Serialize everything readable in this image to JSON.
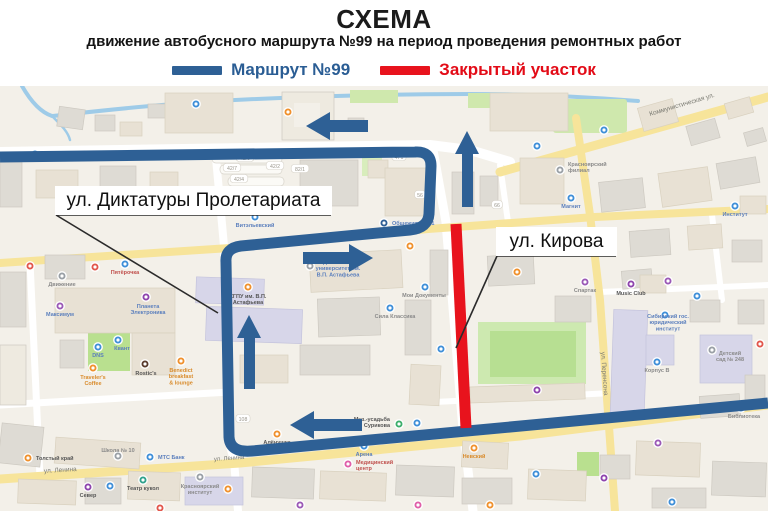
{
  "header": {
    "title": "СХЕМА",
    "subtitle": "движение автобусного маршрута №99 на период проведения ремонтных работ"
  },
  "legend": {
    "route": {
      "label": "Маршрут №99",
      "color": "#2e6095"
    },
    "closed": {
      "label": "Закрытый участок",
      "color": "#e8131d"
    }
  },
  "map": {
    "route": {
      "name": "Маршрут №99",
      "color": "#2e6095",
      "width": 11,
      "svg_path": "M 768,403 L 252,451 Q 230,453 229,437 L 226,262 Q 225,248 241,246 L 410,230 Q 428,228 429,214 L 431,166 Q 431,151 415,152 L 0,157",
      "arrows": [
        {
          "dir": "left",
          "points": "306,126 330,112 330,120 368,120 368,132 330,132 330,140"
        },
        {
          "dir": "up",
          "points": "467,131 455,154 462,154 462,207 473,207 473,154 479,154"
        },
        {
          "dir": "right",
          "points": "373,258 349,244 349,252 303,252 303,264 349,264 349,272"
        },
        {
          "dir": "up",
          "points": "249,315 237,338 244,338 244,389 255,389 255,338 261,338"
        },
        {
          "dir": "left",
          "points": "290,425 314,411 314,419 362,419 362,431 314,431 314,439"
        }
      ]
    },
    "closed_section": {
      "name": "Закрытый участок",
      "color": "#e8131d",
      "width": 11,
      "x1": 456,
      "y1": 224,
      "x2": 466,
      "y2": 428
    },
    "callouts": [
      {
        "label": "ул. Диктатуры Пролетариата",
        "box": {
          "x": 55,
          "y": 186,
          "w": 277,
          "h": 29
        },
        "underline": {
          "x1": 56,
          "y1": 215,
          "x2": 331,
          "y2": 215
        },
        "leader": {
          "x1": 56,
          "y1": 215,
          "x2": 218,
          "y2": 313
        }
      },
      {
        "label": "ул. Кирова",
        "box": {
          "x": 496,
          "y": 227,
          "w": 121,
          "h": 29
        },
        "underline": {
          "x1": 497,
          "y1": 256,
          "x2": 616,
          "y2": 256
        },
        "leader": {
          "x1": 497,
          "y1": 256,
          "x2": 456,
          "y2": 348
        }
      }
    ],
    "street_names": [
      {
        "text": "Коммунистическая ул.",
        "x": 650,
        "y": 116,
        "rotate": -16.5,
        "size": 6.5
      },
      {
        "text": "ул. Перенсона",
        "x": 601,
        "y": 352,
        "rotate": 86,
        "size": 6.5
      },
      {
        "text": "ул. Ленина",
        "x": 44,
        "y": 473,
        "rotate": -3.5,
        "size": 6.5
      },
      {
        "text": "ул. Ленина",
        "x": 214,
        "y": 461,
        "rotate": -4,
        "size": 6
      }
    ],
    "pois": [
      {
        "x": 288,
        "y": 112,
        "c": "#f0912d"
      },
      {
        "x": 35,
        "y": 154,
        "c": "#3f8fd8"
      },
      {
        "x": 196,
        "y": 104,
        "c": "#3f8fd8"
      },
      {
        "x": 537,
        "y": 146,
        "c": "#3f8fd8"
      },
      {
        "x": 604,
        "y": 130,
        "c": "#3f8fd8"
      },
      {
        "x": 560,
        "y": 170,
        "c": "#9aa0a6",
        "lines": [
          "Красноярский",
          "филиал"
        ],
        "lx": 568,
        "ly": 166,
        "lc": "#8a8a8a",
        "anchor": "start"
      },
      {
        "x": 571,
        "y": 198,
        "c": "#3f8fd8",
        "lines": [
          "Магнит"
        ],
        "lx": 571,
        "ly": 208,
        "lc": "#5b7fbd"
      },
      {
        "x": 255,
        "y": 217,
        "c": "#3f8fd8",
        "lines": [
          "Витэльевский"
        ],
        "lx": 255,
        "ly": 227,
        "lc": "#5b7fbd"
      },
      {
        "x": 384,
        "y": 223,
        "c": "#2f5f96",
        "lines": [
          "Общежитие №1"
        ],
        "lx": 392,
        "ly": 225,
        "lc": "#5b7fbd",
        "anchor": "start"
      },
      {
        "x": 410,
        "y": 246,
        "c": "#f0912d"
      },
      {
        "x": 517,
        "y": 272,
        "c": "#f0912d"
      },
      {
        "x": 585,
        "y": 282,
        "c": "#9b59b6",
        "lines": [
          "Спартак"
        ],
        "lx": 585,
        "ly": 292,
        "lc": "#8a8a8a"
      },
      {
        "x": 631,
        "y": 284,
        "c": "#8e44ad",
        "lines": [
          "Music Club"
        ],
        "lx": 631,
        "ly": 295,
        "lc": "#555555"
      },
      {
        "x": 668,
        "y": 281,
        "c": "#9b59b6"
      },
      {
        "x": 697,
        "y": 296,
        "c": "#3f8fd8"
      },
      {
        "x": 735,
        "y": 206,
        "c": "#3f8fd8",
        "lines": [
          "Институт"
        ],
        "lx": 735,
        "ly": 216,
        "lc": "#5b7fbd"
      },
      {
        "x": 244,
        "y": 199,
        "c": "#3f8fd8"
      },
      {
        "x": 95,
        "y": 267,
        "c": "#e2574c"
      },
      {
        "x": 30,
        "y": 266,
        "c": "#e2574c"
      },
      {
        "x": 62,
        "y": 276,
        "c": "#9aa0a6",
        "lines": [
          "Движение"
        ],
        "lx": 62,
        "ly": 286,
        "lc": "#8a8a8a"
      },
      {
        "x": 125,
        "y": 264,
        "c": "#3f8fd8",
        "lines": [
          "Пятёрочка"
        ],
        "lx": 125,
        "ly": 274,
        "lc": "#c0504d"
      },
      {
        "x": 60,
        "y": 306,
        "c": "#9b59b6",
        "lines": [
          "Максимум"
        ],
        "lx": 60,
        "ly": 316,
        "lc": "#5b7fbd"
      },
      {
        "x": 146,
        "y": 297,
        "c": "#8e44ad",
        "lines": [
          "Планета",
          "Электроника"
        ],
        "lx": 148,
        "ly": 308,
        "lc": "#5b7fbd"
      },
      {
        "x": 98,
        "y": 347,
        "c": "#3f8fd8",
        "lines": [
          "DNS"
        ],
        "lx": 98,
        "ly": 357,
        "lc": "#5b7fbd"
      },
      {
        "x": 118,
        "y": 340,
        "c": "#3f8fd8",
        "lines": [
          "Квант"
        ],
        "lx": 122,
        "ly": 350,
        "lc": "#5b7fbd"
      },
      {
        "x": 145,
        "y": 364,
        "c": "#5a3c2e",
        "lines": [
          "Rostic's"
        ],
        "lx": 146,
        "ly": 375,
        "lc": "#555555"
      },
      {
        "x": 93,
        "y": 368,
        "c": "#f0912d",
        "lines": [
          "Traveler's",
          "Coffee"
        ],
        "lx": 93,
        "ly": 379,
        "lc": "#d98b2b"
      },
      {
        "x": 181,
        "y": 361,
        "c": "#f0912d",
        "lines": [
          "Benedict",
          "breakfast",
          "& lounge"
        ],
        "lx": 181,
        "ly": 372,
        "lc": "#d98b2b"
      },
      {
        "x": 248,
        "y": 287,
        "c": "#f0912d",
        "lines": [
          "КГПУ им. В.П.",
          "Астафьева"
        ],
        "lx": 248,
        "ly": 298,
        "lc": "#555555"
      },
      {
        "x": 310,
        "y": 266,
        "c": "#9aa0a6",
        "lines": [
          "Педагогический",
          "университет им.",
          "В.П. Астафьева"
        ],
        "lx": 338,
        "ly": 264,
        "lc": "#5b7fbd"
      },
      {
        "x": 390,
        "y": 308,
        "c": "#3f8fd8",
        "lines": [
          "Сила Классика"
        ],
        "lx": 395,
        "ly": 318,
        "lc": "#8a8a8a"
      },
      {
        "x": 425,
        "y": 287,
        "c": "#3f8fd8",
        "lines": [
          "Мои Документы"
        ],
        "lx": 424,
        "ly": 297,
        "lc": "#8a8a8a"
      },
      {
        "x": 441,
        "y": 349,
        "c": "#3f8fd8"
      },
      {
        "x": 537,
        "y": 390,
        "c": "#8e44ad"
      },
      {
        "x": 399,
        "y": 424,
        "c": "#3dae6b",
        "lines": [
          "Муз.-усадьба",
          "Сурикова"
        ],
        "lx": 390,
        "ly": 421,
        "lc": "#555555",
        "anchor": "end"
      },
      {
        "x": 417,
        "y": 423,
        "c": "#3f8fd8"
      },
      {
        "x": 277,
        "y": 434,
        "c": "#f0912d",
        "lines": [
          "Алёнушка"
        ],
        "lx": 277,
        "ly": 444,
        "lc": "#555555"
      },
      {
        "x": 657,
        "y": 362,
        "c": "#3f8fd8",
        "lines": [
          "Корпус В"
        ],
        "lx": 657,
        "ly": 372,
        "lc": "#8a8a8a"
      },
      {
        "x": 712,
        "y": 350,
        "c": "#9aa0a6",
        "lines": [
          "Детский",
          "сад № 248"
        ],
        "lx": 730,
        "ly": 355,
        "lc": "#8a8a8a"
      },
      {
        "x": 760,
        "y": 344,
        "c": "#e2574c"
      },
      {
        "x": 741,
        "y": 408,
        "c": "#3f8fd8",
        "lines": [
          "Библиотека"
        ],
        "lx": 744,
        "ly": 418,
        "lc": "#8a8a8a"
      },
      {
        "x": 665,
        "y": 315,
        "c": "#3f8fd8",
        "lines": [
          "Сибирский гос.",
          "юридический",
          "институт"
        ],
        "lx": 668,
        "ly": 318,
        "lc": "#5b7fbd"
      },
      {
        "x": 28,
        "y": 458,
        "c": "#f0912d",
        "lines": [
          "Толстый край"
        ],
        "lx": 36,
        "ly": 460,
        "lc": "#555555",
        "anchor": "start"
      },
      {
        "x": 150,
        "y": 457,
        "c": "#3f8fd8",
        "lines": [
          "МТС Банк"
        ],
        "lx": 158,
        "ly": 459,
        "lc": "#5b7fbd",
        "anchor": "start"
      },
      {
        "x": 118,
        "y": 456,
        "c": "#9aa0a6",
        "lines": [
          "Школа № 10"
        ],
        "lx": 118,
        "ly": 452,
        "lc": "#8a8a8a"
      },
      {
        "x": 88,
        "y": 487,
        "c": "#8e44ad",
        "lines": [
          "Север"
        ],
        "lx": 88,
        "ly": 497,
        "lc": "#555555"
      },
      {
        "x": 110,
        "y": 486,
        "c": "#3f8fd8"
      },
      {
        "x": 143,
        "y": 480,
        "c": "#2fa18c",
        "lines": [
          "Театр кукол"
        ],
        "lx": 143,
        "ly": 490,
        "lc": "#555555"
      },
      {
        "x": 200,
        "y": 477,
        "c": "#9aa0a6",
        "lines": [
          "Красноярский",
          "институт"
        ],
        "lx": 200,
        "ly": 488,
        "lc": "#8a8a8a"
      },
      {
        "x": 228,
        "y": 489,
        "c": "#f0912d"
      },
      {
        "x": 348,
        "y": 464,
        "c": "#e05fa9",
        "lines": [
          "Медицинский",
          "центр"
        ],
        "lx": 356,
        "ly": 464,
        "lc": "#c0504d",
        "anchor": "start"
      },
      {
        "x": 364,
        "y": 446,
        "c": "#3f8fd8",
        "lines": [
          "Арена"
        ],
        "lx": 364,
        "ly": 456,
        "lc": "#5b7fbd"
      },
      {
        "x": 474,
        "y": 448,
        "c": "#f0912d",
        "lines": [
          "Невский"
        ],
        "lx": 474,
        "ly": 458,
        "lc": "#d98b2b"
      },
      {
        "x": 658,
        "y": 443,
        "c": "#9b59b6"
      },
      {
        "x": 536,
        "y": 474,
        "c": "#3f8fd8"
      },
      {
        "x": 604,
        "y": 478,
        "c": "#8e44ad"
      },
      {
        "x": 672,
        "y": 502,
        "c": "#3f8fd8"
      },
      {
        "x": 490,
        "y": 505,
        "c": "#f0912d"
      },
      {
        "x": 418,
        "y": 505,
        "c": "#e05fa9"
      },
      {
        "x": 300,
        "y": 505,
        "c": "#9b59b6"
      },
      {
        "x": 160,
        "y": 508,
        "c": "#e2574c"
      }
    ],
    "plates": [
      {
        "t": "42/9",
        "x": 245,
        "y": 159
      },
      {
        "t": "42/7",
        "x": 232,
        "y": 169
      },
      {
        "t": "42/2",
        "x": 275,
        "y": 167
      },
      {
        "t": "42/4",
        "x": 239,
        "y": 180
      },
      {
        "t": "82/1",
        "x": 300,
        "y": 170
      },
      {
        "t": "471",
        "x": 399,
        "y": 158
      },
      {
        "t": "108",
        "x": 243,
        "y": 420
      },
      {
        "t": "56",
        "x": 420,
        "y": 196
      },
      {
        "t": "66",
        "x": 497,
        "y": 206
      },
      {
        "t": "63",
        "x": 523,
        "y": 240
      }
    ]
  }
}
